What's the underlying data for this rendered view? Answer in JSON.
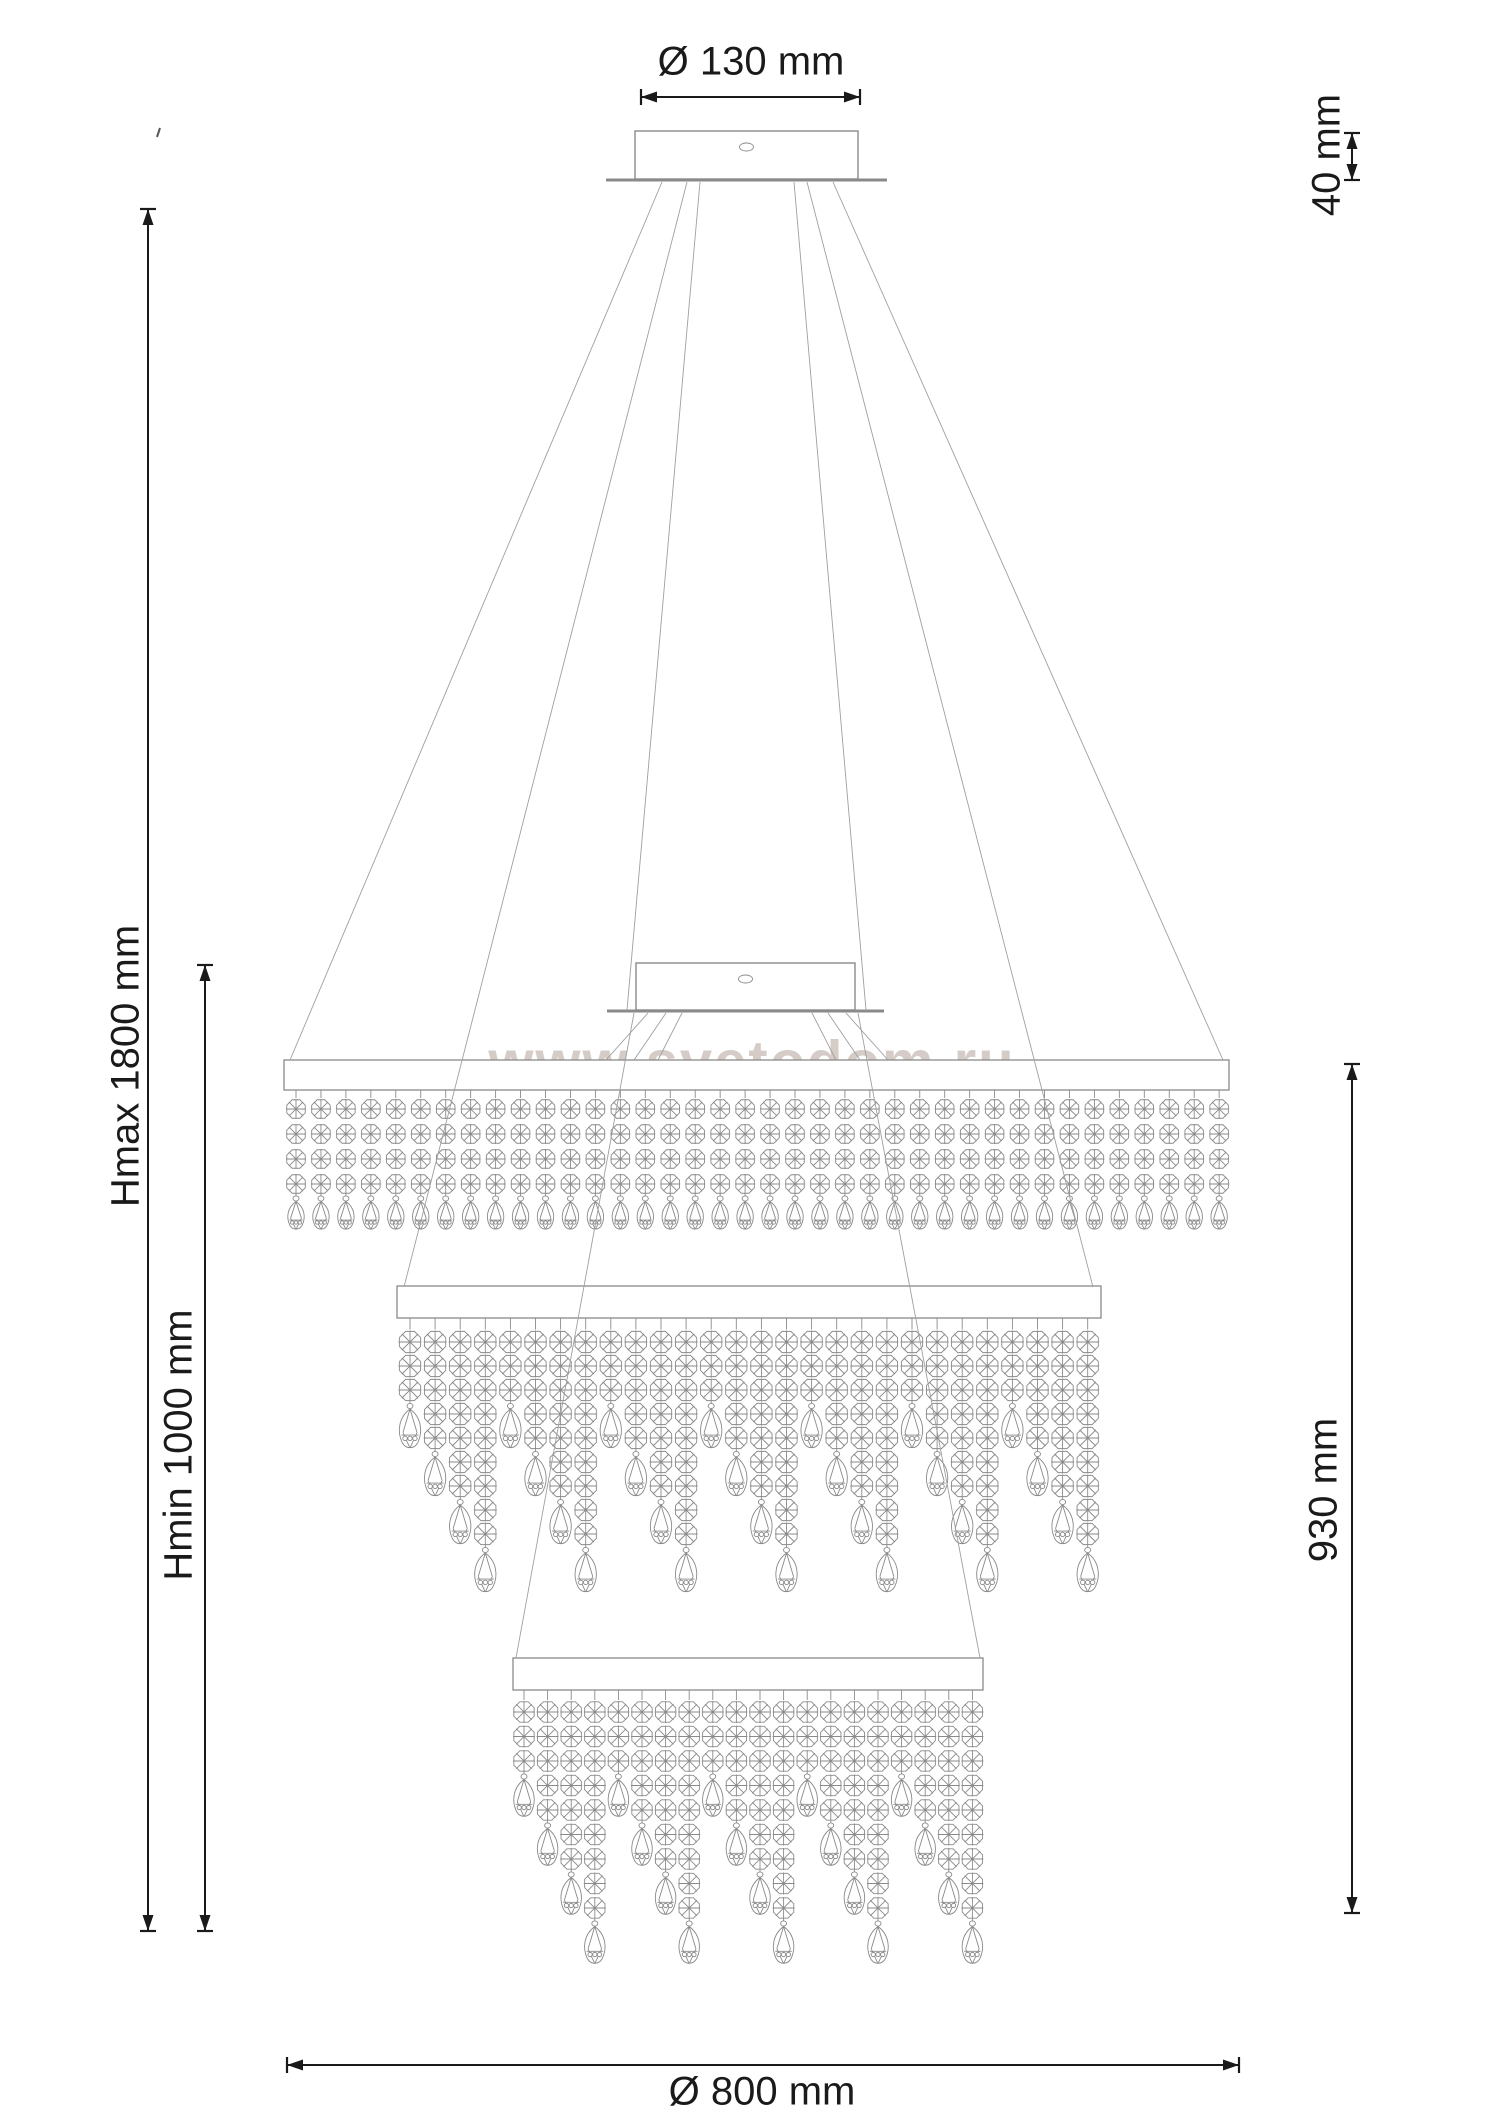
{
  "diagram": {
    "watermark": "www.svetodom.ru",
    "dimensions": {
      "canopy_diameter": "Ø 130 mm",
      "canopy_height": "40 mm",
      "height_max": "Hmax 1800 mm",
      "height_min": "Hmin 1000 mm",
      "body_height": "930 mm",
      "body_diameter": "Ø 800 mm"
    },
    "colors": {
      "dimension_ink": "#1a1a1a",
      "drawing_line": "#8a8a8a",
      "cable_line": "#9f9f9f",
      "watermark": "#b3a49a"
    },
    "figure": {
      "type": "three-tier-crystal-chandelier-front-elevation",
      "canopies": 2,
      "tier_strand_counts": [
        38,
        28,
        20
      ],
      "tier1_octagons_per_strand": 4,
      "cascade_octagon_cycle": [
        3,
        5,
        7,
        9
      ],
      "bead_style": "faceted-octagon-chains-with-teardrop-pendants"
    }
  }
}
